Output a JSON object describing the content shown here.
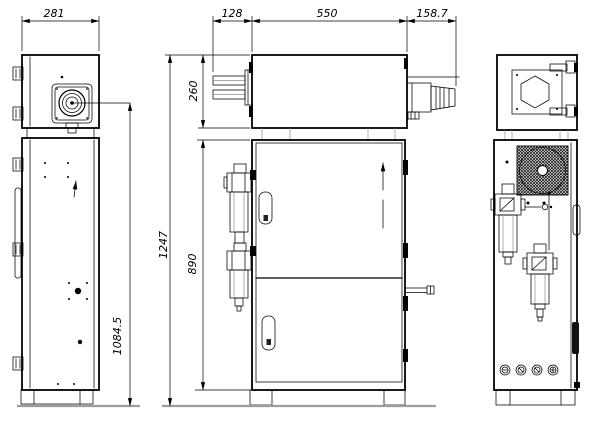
{
  "drawing": {
    "type": "engineering three-view technical drawing",
    "subject": "electrical control cabinet with top junction box, pneumatic FRL units, fan grille and round panel connectors",
    "views": {
      "left": "left side view",
      "front": "front view",
      "right": "right side view"
    }
  },
  "dims": {
    "d281": "281",
    "d128": "128",
    "d550": "550",
    "d158_7": "158.7",
    "d260": "260",
    "d890": "890",
    "d1247": "1247",
    "d1084_5": "1084.5"
  },
  "colors": {
    "line": "#000000",
    "ground": "#9c9c9c",
    "background": "#ffffff"
  }
}
